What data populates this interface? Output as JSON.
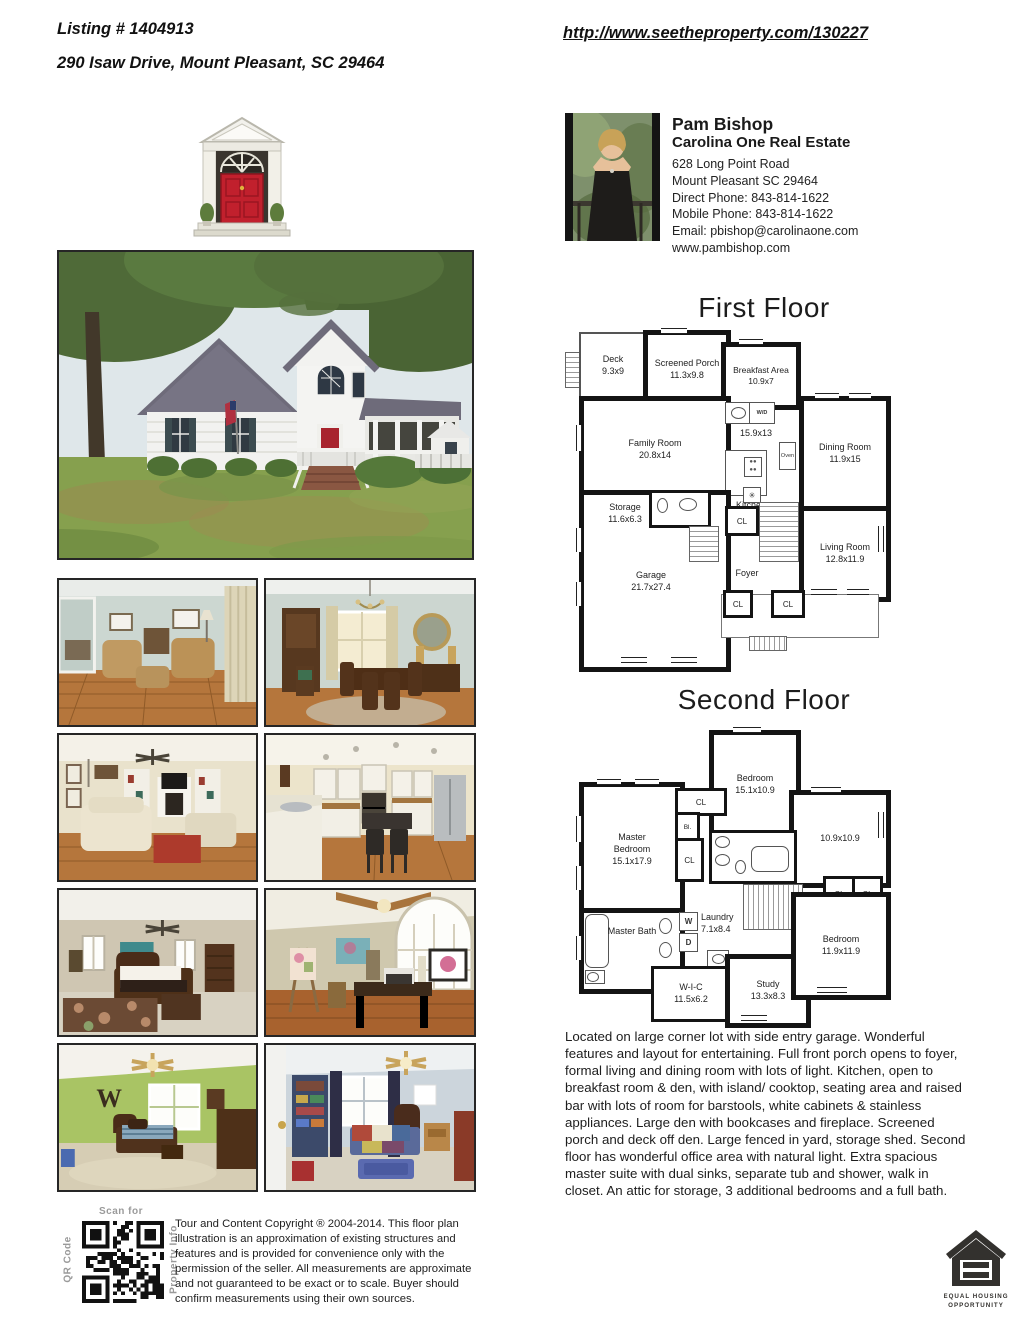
{
  "header": {
    "listing": "Listing # 1404913",
    "address": "290 Isaw Drive, Mount Pleasant, SC 29464",
    "url": "http://www.seetheproperty.com/130227"
  },
  "agent": {
    "name": "Pam Bishop",
    "company": "Carolina One Real Estate",
    "address1": "628 Long Point Road",
    "address2": "Mount Pleasant SC 29464",
    "direct_phone": "Direct Phone: 843-814-1622",
    "mobile_phone": "Mobile Phone: 843-814-1622",
    "email": "Email: pbishop@carolinaone.com",
    "website": "www.pambishop.com"
  },
  "first_floor": {
    "title": "First Floor",
    "rooms": {
      "deck_name": "Deck",
      "deck_dims": "9.3x9",
      "porch_name": "Screened Porch",
      "porch_dims": "11.3x9.8",
      "breakfast_name": "Breakfast Area",
      "breakfast_dims": "10.9x7",
      "family_name": "Family Room",
      "family_dims": "20.8x14",
      "kitchen_dims": "15.9x13",
      "kitchen_name": "Kitchen",
      "oven": "Oven",
      "wd": "W/D",
      "fan_symbol": "✳",
      "dining_name": "Dining Room",
      "dining_dims": "11.9x15",
      "storage_name": "Storage",
      "storage_dims": "11.6x6.3",
      "garage_name": "Garage",
      "garage_dims": "21.7x27.4",
      "foyer_name": "Foyer",
      "living_name": "Living Room",
      "living_dims": "12.8x11.9",
      "cl": "CL"
    }
  },
  "second_floor": {
    "title": "Second Floor",
    "rooms": {
      "bedroom_top_name": "Bedroom",
      "bedroom_top_dims": "15.1x10.9",
      "master_name": "Master Bedroom",
      "master_dims": "15.1x17.9",
      "room10_dims": "10.9x10.9",
      "cl": "CL",
      "bl": "Bl.",
      "masterbath_name": "Master Bath",
      "w": "W",
      "d": "D",
      "laundry_name": "Laundry",
      "laundry_dims": "7.1x8.4",
      "wic_name": "W-I-C",
      "wic_dims": "11.5x6.2",
      "study_name": "Study",
      "study_dims": "13.3x8.3",
      "bedroom_right_name": "Bedroom",
      "bedroom_right_dims": "11.9x11.9"
    }
  },
  "photos": {
    "w_letter": "W",
    "b_letter": "B"
  },
  "description": "Located on large corner lot with side entry garage. Wonderful features and layout for entertaining. Full front porch opens to foyer, formal living and dining room with lots of light. Kitchen, open to breakfast room & den, with island/ cooktop, seating area and raised bar with lots of room for barstools, white cabinets & stainless appliances. Large den with bookcases and fireplace. Screened porch and deck off den. Large fenced in yard, storage shed. Second floor has wonderful office area with natural light. Extra spacious master suite with dual sinks, separate tub and shower, walk in closet. An attic for storage, 3 additional bedrooms and a full bath.",
  "footer": {
    "scan_for": "Scan for",
    "qr_code": "QR Code",
    "property_info": "Property Info",
    "copyright": "Tour and Content Copyright ® 2004-2014. This floor plan illustration is an approximation of existing structures and features and is provided for convenience only with the permission of the seller. All measurements are approximate and not guaranteed to be exact or to scale. Buyer should confirm measurements using their own sources.",
    "equal_housing_1": "EQUAL HOUSING",
    "equal_housing_2": "OPPORTUNITY"
  }
}
